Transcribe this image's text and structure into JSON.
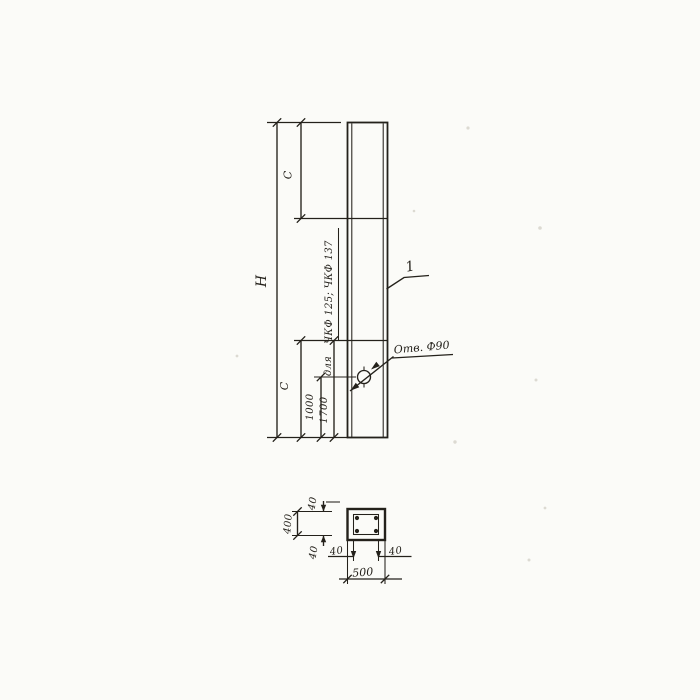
{
  "drawing": {
    "elevation": {
      "height_label": "H",
      "c_upper_label": "C",
      "c_lower_label": "C",
      "dim_hole_to_base": "1000",
      "dim_line_to_base": "1700",
      "note_for": "для",
      "note_marks": "ЧКФ 125; ЧКФ 137",
      "hole_label": "Отв. Ф90",
      "item_mark": "1"
    },
    "section": {
      "overall_width": "500",
      "overall_height": "400",
      "cover_top": "40",
      "cover_bottom": "40",
      "cover_left": "40",
      "cover_right": "40"
    },
    "colors": {
      "ink": "#24211b",
      "paper": "#fbfbf8"
    }
  }
}
